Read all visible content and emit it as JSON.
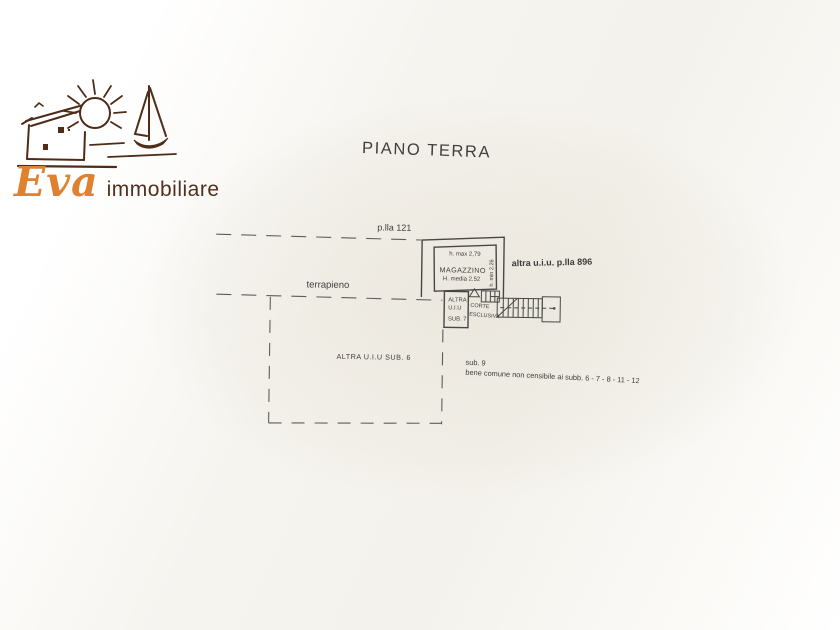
{
  "brand": {
    "name_script": "Eva",
    "name_rest": "immobiliare"
  },
  "title": "PIANO TERRA",
  "plan": {
    "parcel_label": "p.lla 121",
    "terrapieno_label": "terrapieno",
    "altra_uiu_parcel_label": "altra u.i.u. p.lla 896",
    "magazzino": {
      "name": "MAGAZZINO",
      "h_max": "h. max 2,79",
      "h_media": "H. media 2.52",
      "h_min": "h. min 2.26"
    },
    "sub7": {
      "line1": "ALTRA",
      "line2": "U.I.U",
      "line3": "SUB. 7"
    },
    "corte": {
      "line1": "CORTE",
      "line2": "ESCLUSIVA"
    },
    "sub6_label": "ALTRA U.I.U SUB. 6",
    "sub9_label": "sub. 9",
    "bene_comune_label": "bene comune non censibile ai subb. 6 - 7 - 8 - 11 - 12"
  }
}
